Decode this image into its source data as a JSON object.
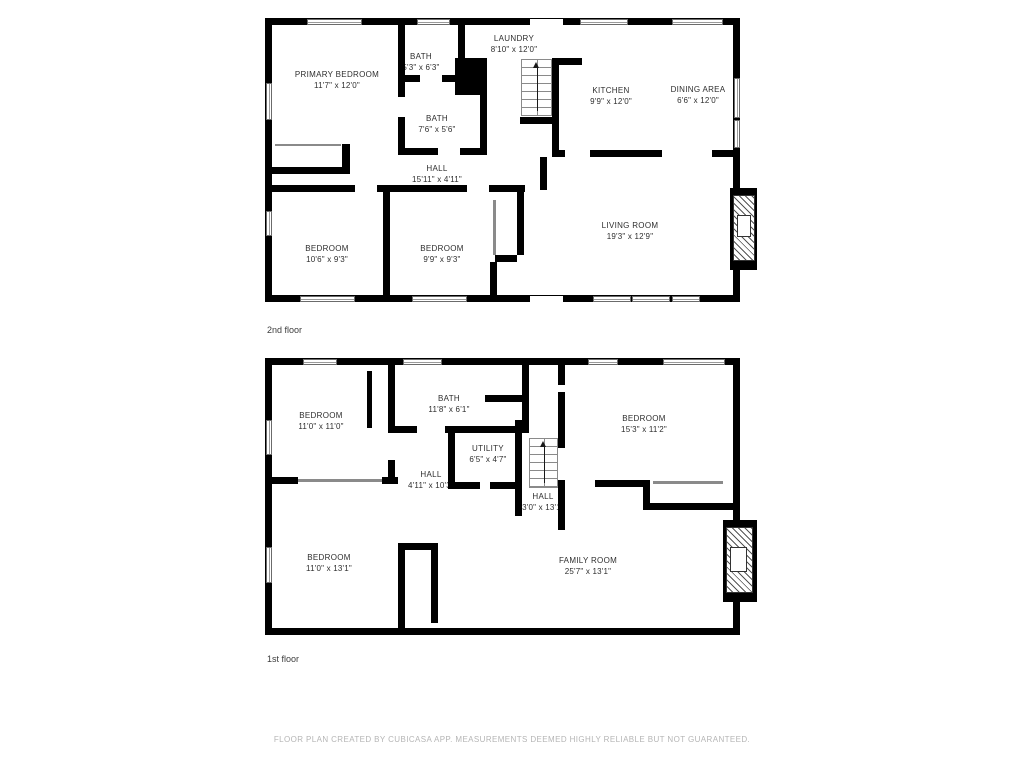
{
  "floors": [
    {
      "name": "2nd floor",
      "rooms": [
        {
          "label": "PRIMARY BEDROOM",
          "dimensions": "11'7\" x 12'0\""
        },
        {
          "label": "BATH",
          "dimensions": "5'3\" x 6'3\""
        },
        {
          "label": "LAUNDRY",
          "dimensions": "8'10\" x 12'0\""
        },
        {
          "label": "KITCHEN",
          "dimensions": "9'9\" x 12'0\""
        },
        {
          "label": "DINING AREA",
          "dimensions": "6'6\" x 12'0\""
        },
        {
          "label": "BATH",
          "dimensions": "7'6\" x 5'6\""
        },
        {
          "label": "HALL",
          "dimensions": "15'11\" x 4'11\""
        },
        {
          "label": "BEDROOM",
          "dimensions": "10'6\" x 9'3\""
        },
        {
          "label": "BEDROOM",
          "dimensions": "9'9\" x 9'3\""
        },
        {
          "label": "LIVING ROOM",
          "dimensions": "19'3\" x 12'9\""
        }
      ]
    },
    {
      "name": "1st floor",
      "rooms": [
        {
          "label": "BEDROOM",
          "dimensions": "11'0\" x 11'0\""
        },
        {
          "label": "BATH",
          "dimensions": "11'8\" x 6'1\""
        },
        {
          "label": "BEDROOM",
          "dimensions": "15'3\" x 11'2\""
        },
        {
          "label": "UTILITY",
          "dimensions": "6'5\" x 4'7\""
        },
        {
          "label": "HALL",
          "dimensions": "4'11\" x 10'3\""
        },
        {
          "label": "HALL",
          "dimensions": "3'0\" x 13'1\""
        },
        {
          "label": "BEDROOM",
          "dimensions": "11'0\" x 13'1\""
        },
        {
          "label": "FAMILY ROOM",
          "dimensions": "25'7\" x 13'1\""
        }
      ]
    }
  ],
  "footer": {
    "text": "FLOOR PLAN CREATED BY CUBICASA APP. MEASUREMENTS DEEMED HIGHLY RELIABLE BUT NOT GUARANTEED."
  },
  "colors": {
    "wall": "#000000",
    "room_label": "#2e2e2e",
    "floor_label": "#3c3c3c",
    "footer_text": "#b5b5b5"
  }
}
